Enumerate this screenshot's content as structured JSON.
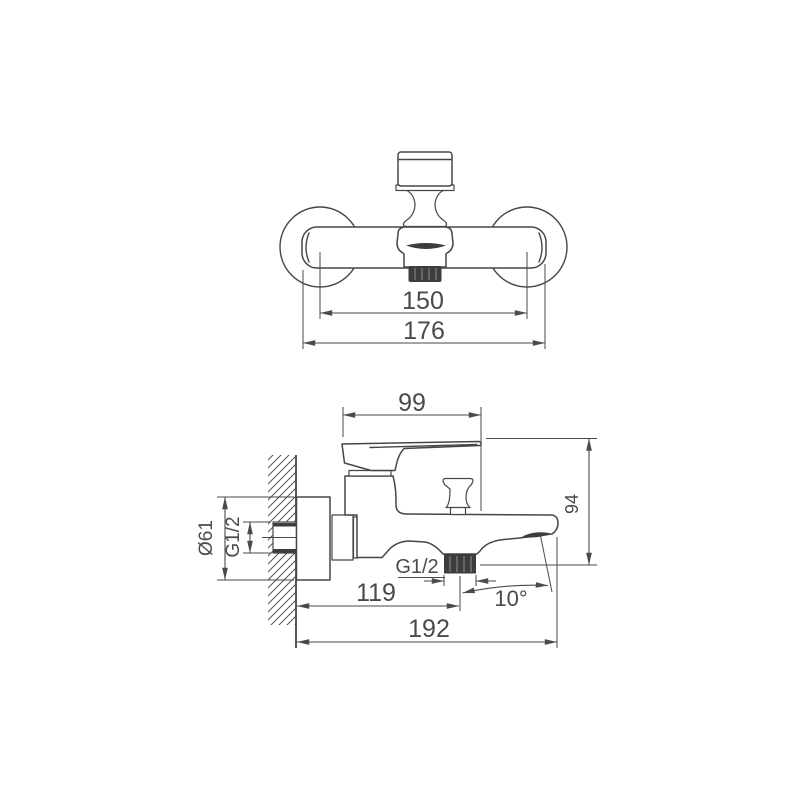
{
  "drawing": {
    "front_view": {
      "center_distance": "150",
      "overall_width": "176"
    },
    "side_view": {
      "handle_length": "99",
      "height": "94",
      "flange_diameter": "Ø61",
      "inlet_thread": "G1/2",
      "outlet_thread": "G1/2",
      "wall_to_spout_outlet": "119",
      "overall_depth": "192",
      "spout_angle": "10°"
    },
    "colors": {
      "line": "#464646",
      "dim_line": "#4a4a4a",
      "dark_fill": "#3d3d3d",
      "background": "#ffffff"
    }
  }
}
